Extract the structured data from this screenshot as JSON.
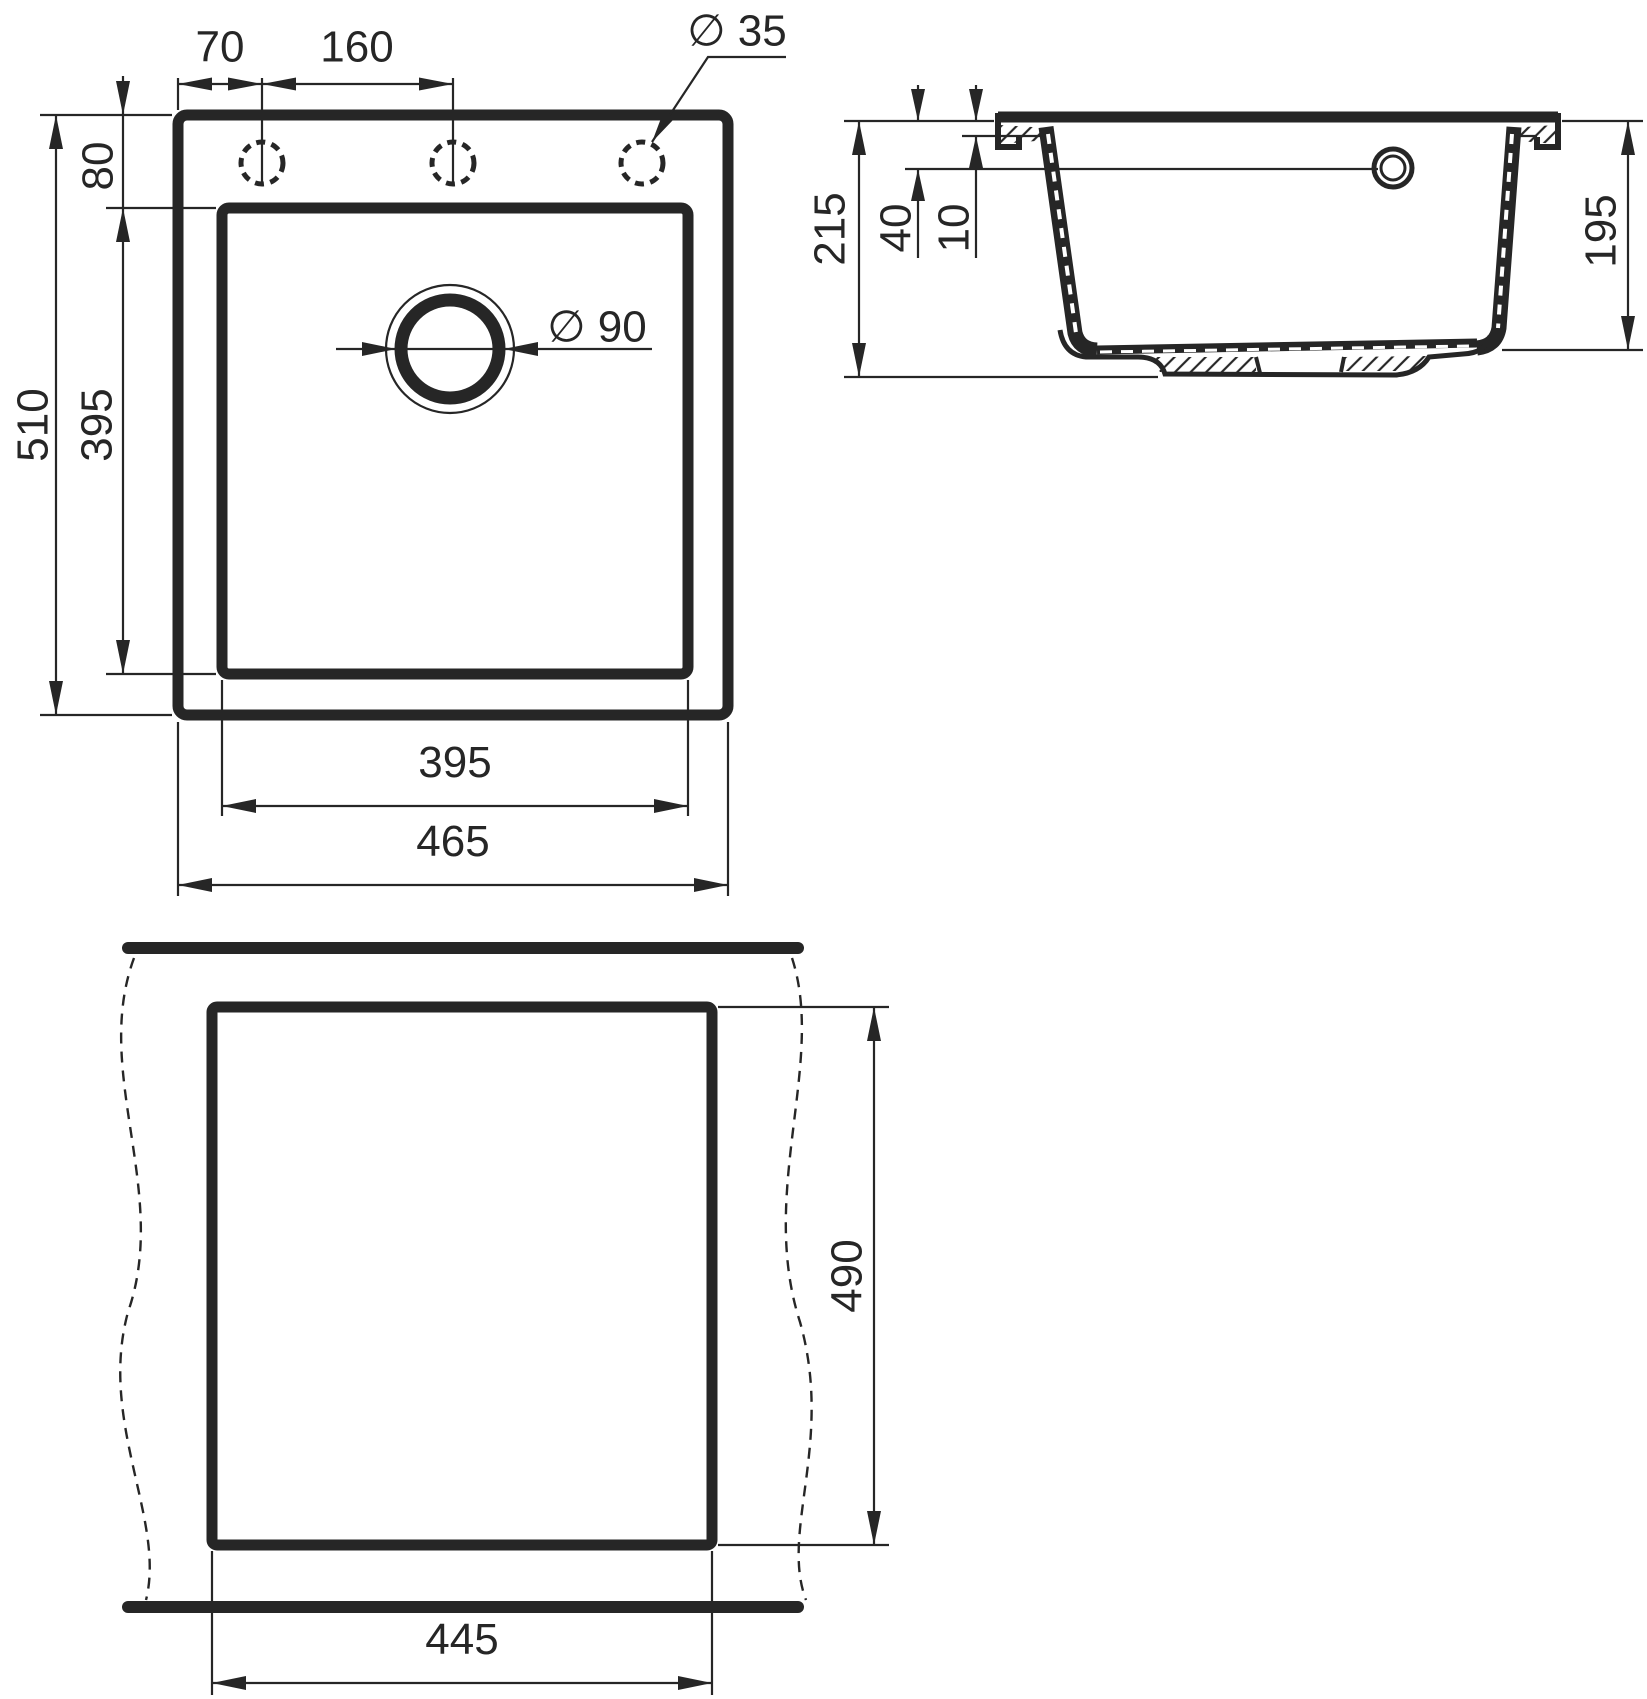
{
  "page": {
    "line_color": "#262626",
    "background": "#ffffff"
  },
  "views": {
    "top_view": {
      "dims": {
        "hole_offset": "70",
        "hole_pitch": "160",
        "hole_diameter": "∅ 35",
        "rim_to_bowl": "80",
        "overall_length": "510",
        "bowl_length": "395",
        "drain_diameter": "∅ 90",
        "bowl_width": "395",
        "overall_width": "465"
      }
    },
    "section_view": {
      "dims": {
        "overall_height": "215",
        "overflow_offset": "40",
        "rim_thickness": "10",
        "bowl_depth": "195"
      }
    },
    "cutout_view": {
      "dims": {
        "cutout_depth": "490",
        "cutout_width": "445"
      }
    }
  }
}
